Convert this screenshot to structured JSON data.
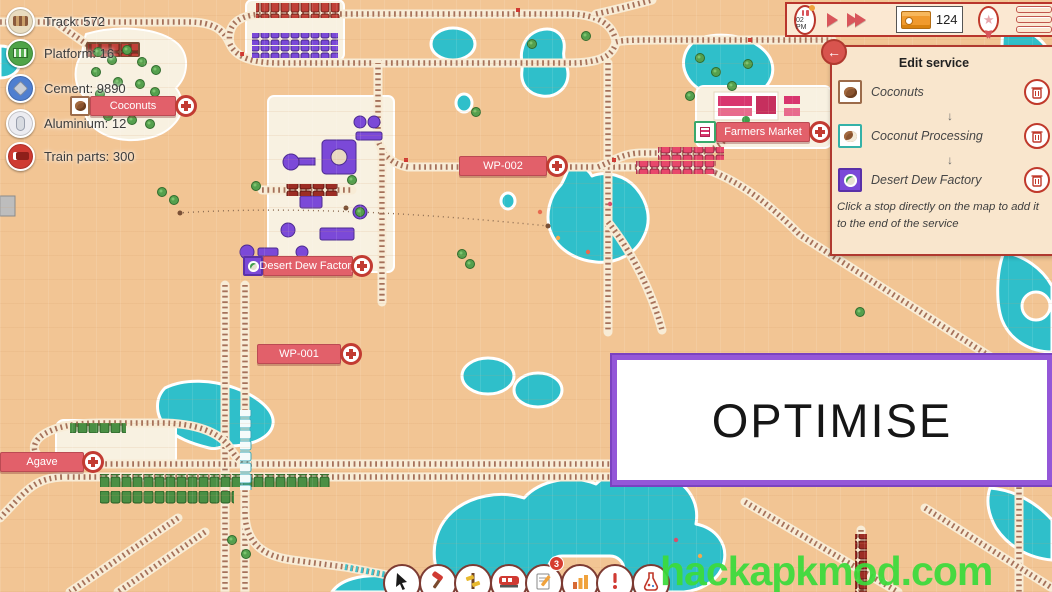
{
  "hud_resources": {
    "items": [
      {
        "icon": "track-icon",
        "label": "Track: 572"
      },
      {
        "icon": "platform-icon",
        "label": "Platform: 16"
      },
      {
        "icon": "cement-icon",
        "label": "Cement: 9890"
      },
      {
        "icon": "aluminium-icon",
        "label": "Aluminium: 12"
      },
      {
        "icon": "train-parts-icon",
        "label": "Train parts: 300"
      }
    ]
  },
  "topbar": {
    "time": "02 PM",
    "cargo_count": "124"
  },
  "edit_service": {
    "title": "Edit service",
    "arrow": "↓",
    "stops": [
      {
        "name": "Coconuts"
      },
      {
        "name": "Coconut Processing"
      },
      {
        "name": "Desert Dew Factory"
      }
    ],
    "hint": "Click a stop directly on the map to add it to the end of the service"
  },
  "map_labels": {
    "coconuts": "Coconuts",
    "farmers_market": "Farmers Market",
    "wp_002": "WP-002",
    "desert_dew_factory": "Desert Dew Factory",
    "wp_001": "WP-001",
    "agave": "Agave"
  },
  "banner": {
    "text": "OPTIMISE"
  },
  "watermark": {
    "text": "hackapkmod.com"
  },
  "bottom_toolbar": {
    "notifications_badge": "3",
    "tools": [
      "select",
      "build",
      "track",
      "trains",
      "tasks",
      "stats",
      "alerts",
      "research"
    ]
  },
  "colors": {
    "sand": "#f2c594",
    "water": "#2fbfca",
    "label_red": "#e2606a",
    "ui_cream": "#fbe8d2",
    "ui_border_red": "#b9352c",
    "banner_purple": "#9457d8",
    "watermark_green": "#3bdb3b",
    "factory_purple": "#7b49d8"
  }
}
